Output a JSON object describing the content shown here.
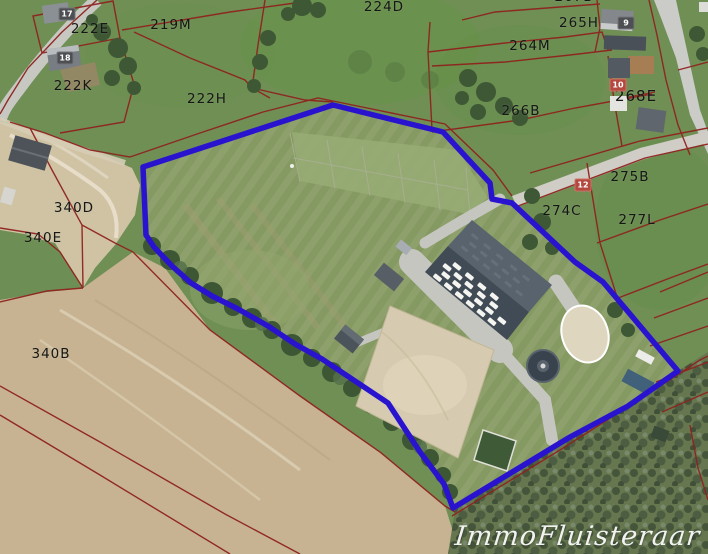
{
  "map": {
    "watermark": "ImmoFluisteraar",
    "outline_color": "#2a13cf",
    "cadastral_color": "#8f231f",
    "parcels": [
      {
        "id": "222E",
        "x": 90,
        "y": 29
      },
      {
        "id": "219M",
        "x": 171,
        "y": 25
      },
      {
        "id": "222K",
        "x": 73,
        "y": 86
      },
      {
        "id": "222H",
        "x": 207,
        "y": 99
      },
      {
        "id": "224D",
        "x": 384,
        "y": 7
      },
      {
        "id": "267B",
        "x": 574,
        "y": -3
      },
      {
        "id": "265H",
        "x": 579,
        "y": 23
      },
      {
        "id": "264M",
        "x": 530,
        "y": 46
      },
      {
        "id": "266B",
        "x": 521,
        "y": 111
      },
      {
        "id": "268E",
        "x": 636,
        "y": 96
      },
      {
        "id": "275B",
        "x": 630,
        "y": 177
      },
      {
        "id": "274C",
        "x": 562,
        "y": 211
      },
      {
        "id": "277L",
        "x": 637,
        "y": 220
      },
      {
        "id": "340D",
        "x": 74,
        "y": 208
      },
      {
        "id": "340E",
        "x": 43,
        "y": 238
      },
      {
        "id": "340B",
        "x": 51,
        "y": 354
      }
    ],
    "markers": [
      {
        "id": "17",
        "x": 67,
        "y": 14,
        "variant": "dark"
      },
      {
        "id": "18",
        "x": 65,
        "y": 58,
        "variant": "dark"
      },
      {
        "id": "9",
        "x": 626,
        "y": 23,
        "variant": "dark"
      },
      {
        "id": "10",
        "x": 618,
        "y": 85,
        "variant": "red"
      },
      {
        "id": "12",
        "x": 583,
        "y": 185,
        "variant": "red"
      }
    ]
  }
}
